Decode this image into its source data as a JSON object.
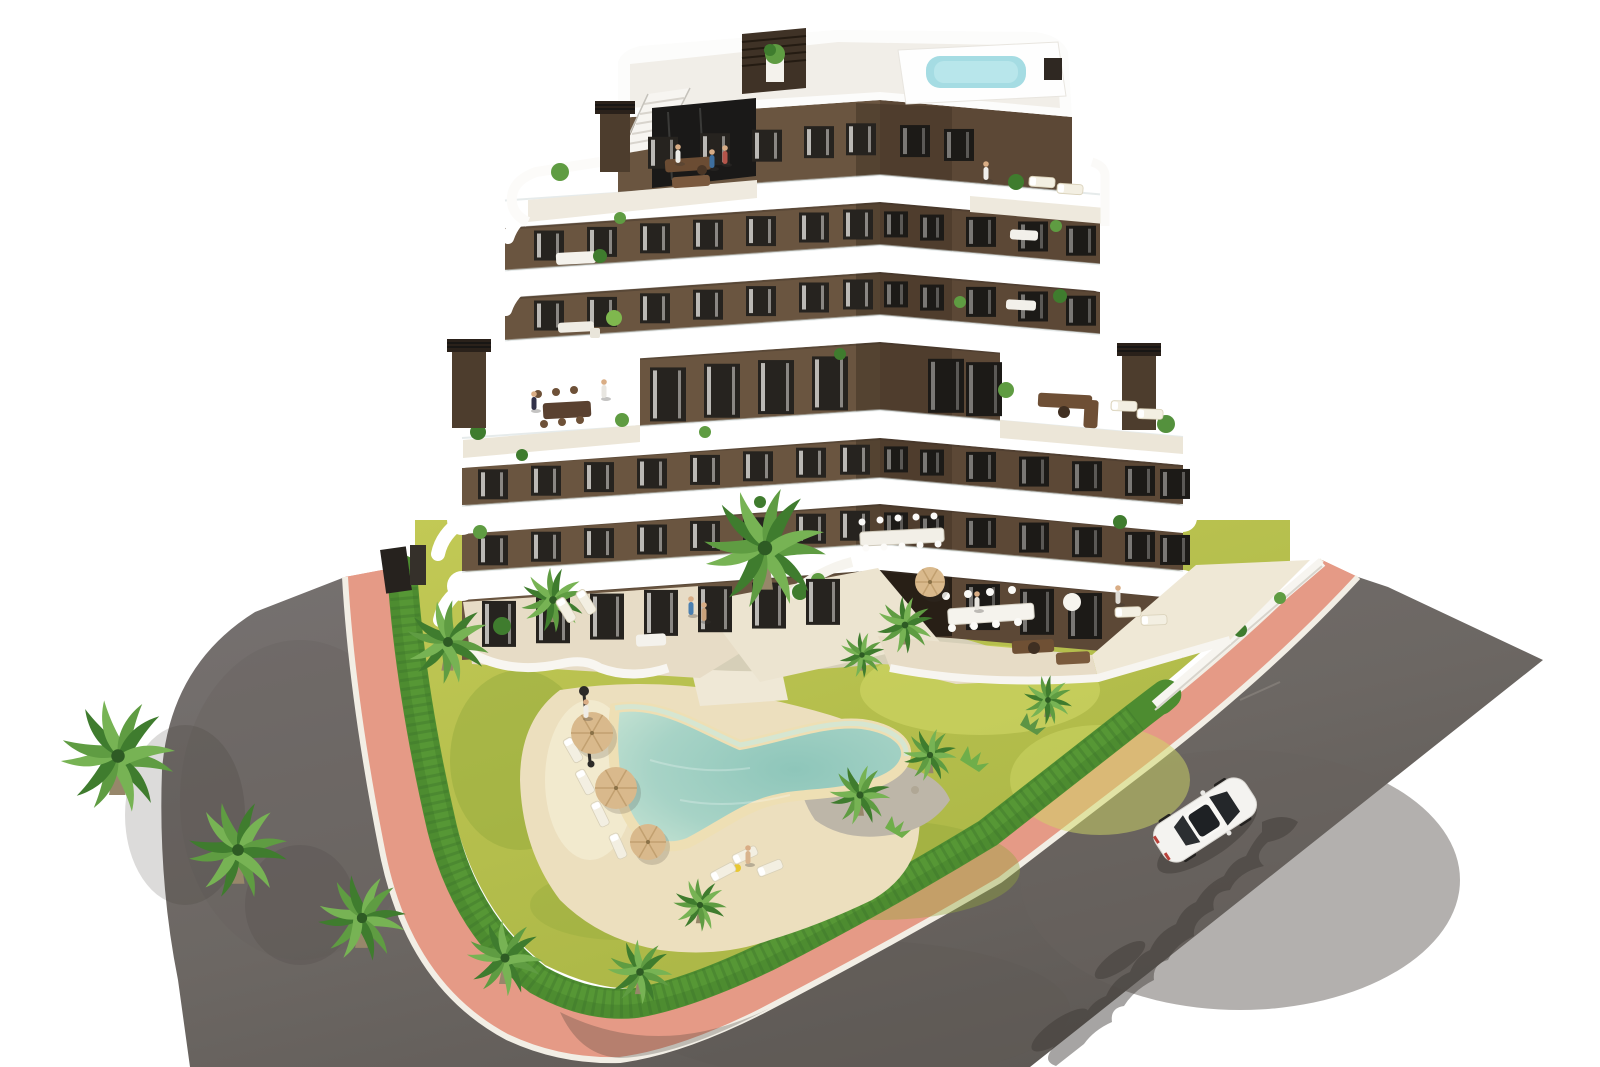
{
  "meta": {
    "title": "Aerial 3D render — modern apartment building with pool garden",
    "scene": "architectural-render"
  },
  "colors": {
    "bg": "#ffffff",
    "road": "#716c68",
    "roadDeep": "#5e5955",
    "roadPatch": "#67625e",
    "scratch": "#9a948c",
    "pink": "#e59a86",
    "pinkDeep": "#d98a75",
    "curb": "#f2eee5",
    "hedge": "#4d8c30",
    "hedgeDark": "#39702a",
    "hedgeLight": "#5ea13a",
    "lawn": "#b9c14e",
    "lawnLight": "#d0d765",
    "lawnDark": "#93a83c",
    "sand": "#ecdfbe",
    "sandLight": "#f4ecd2",
    "gravel": "#bdb6a8",
    "rock": "#b0a795",
    "poolDeep": "#8ec6ba",
    "poolMid": "#a7d3c6",
    "poolShallow": "#cfe7d8",
    "poolRim": "#eedfb4",
    "rooftopPool": "#a5dce3",
    "band": "#ffffff",
    "bandShade": "#dedbd4",
    "slabShadow": "#3c3128",
    "facadeL": "#6a5540",
    "facadeR": "#5c4836",
    "recess": "#463728",
    "archDark": "#281f16",
    "windowGlass": "#26231f",
    "windowGlassDark": "#1c1a17",
    "curtain": "#eeece8",
    "tile": "#e7dcc6",
    "tileLight": "#efe8d6",
    "trunk": "#97876a",
    "palmA": "#5f9c42",
    "palmB": "#3f7c2e",
    "palmC": "#77b354",
    "palmCore": "#2e5b24",
    "umbrella": "#d9b98c",
    "umbrellaRib": "#c2a070",
    "carBody": "#f4f3f0",
    "carGlass": "#24272a",
    "shadow": "#3c3834",
    "metal": "#2c2a27",
    "skin": "#d9ad85",
    "darkWood": "#6b4c33",
    "darkWood2": "#7a593e"
  },
  "building": {
    "floors": 7,
    "has_rooftop_pool": true,
    "has_roof_stair_bulkhead": true,
    "window_rows": [
      {
        "yc": 138,
        "h": 32,
        "w": 30,
        "xs": [
          648,
          700,
          752,
          804,
          846,
          900,
          944
        ]
      },
      {
        "yc": 223,
        "h": 30,
        "w": 30,
        "xs": [
          534,
          587,
          640,
          693,
          746,
          799,
          843,
          966,
          1018,
          1066
        ]
      },
      {
        "yc": 223,
        "h": 26,
        "w": 24,
        "xs": [
          884,
          920
        ],
        "recess": true
      },
      {
        "yc": 293,
        "h": 30,
        "w": 30,
        "xs": [
          534,
          587,
          640,
          693,
          746,
          799,
          843,
          966,
          1018,
          1066
        ]
      },
      {
        "yc": 293,
        "h": 26,
        "w": 24,
        "xs": [
          884,
          920
        ],
        "recess": true
      },
      {
        "yc": 380,
        "h": 54,
        "w": 36,
        "xs": [
          650,
          704,
          758,
          812,
          928,
          966
        ]
      },
      {
        "yc": 458,
        "h": 30,
        "w": 30,
        "xs": [
          478,
          531,
          584,
          637,
          690,
          743,
          796,
          840,
          966,
          1019,
          1072,
          1125,
          1160
        ]
      },
      {
        "yc": 458,
        "h": 26,
        "w": 24,
        "xs": [
          884,
          920
        ],
        "recess": true
      },
      {
        "yc": 524,
        "h": 30,
        "w": 30,
        "xs": [
          478,
          531,
          584,
          637,
          690,
          743,
          796,
          840,
          966,
          1019,
          1072,
          1125,
          1160
        ]
      },
      {
        "yc": 524,
        "h": 26,
        "w": 24,
        "xs": [
          884,
          920
        ],
        "recess": true
      },
      {
        "yc": 598,
        "h": 46,
        "w": 34,
        "xs": [
          482,
          536,
          590,
          644,
          698,
          752,
          806,
          966,
          1020,
          1068
        ]
      }
    ],
    "chimneys": [
      {
        "x": 452,
        "y": 348,
        "w": 34,
        "h": 80
      },
      {
        "x": 1122,
        "y": 352,
        "w": 34,
        "h": 78
      },
      {
        "x": 600,
        "y": 110,
        "w": 30,
        "h": 62
      }
    ]
  },
  "garden": {
    "palms": [
      {
        "x": 118,
        "y": 756,
        "s": 1.5,
        "rot": 10
      },
      {
        "x": 238,
        "y": 850,
        "s": 1.3,
        "rot": 65
      },
      {
        "x": 362,
        "y": 918,
        "s": 1.15,
        "rot": 130
      },
      {
        "x": 505,
        "y": 958,
        "s": 1.0,
        "rot": 20
      },
      {
        "x": 640,
        "y": 972,
        "s": 0.85,
        "rot": 200
      },
      {
        "x": 448,
        "y": 642,
        "s": 1.1,
        "rot": 90
      },
      {
        "x": 553,
        "y": 600,
        "s": 0.85,
        "rot": 160
      },
      {
        "x": 765,
        "y": 548,
        "s": 1.6,
        "rot": 0
      },
      {
        "x": 862,
        "y": 655,
        "s": 0.6,
        "rot": 40
      },
      {
        "x": 905,
        "y": 625,
        "s": 0.75,
        "rot": 220
      },
      {
        "x": 860,
        "y": 795,
        "s": 0.8,
        "rot": 120
      },
      {
        "x": 930,
        "y": 755,
        "s": 0.7,
        "rot": 300
      },
      {
        "x": 1048,
        "y": 700,
        "s": 0.65,
        "rot": 150
      },
      {
        "x": 700,
        "y": 905,
        "s": 0.7,
        "rot": 260
      }
    ],
    "umbrellas": [
      {
        "x": 592,
        "y": 733,
        "r": 21
      },
      {
        "x": 616,
        "y": 788,
        "r": 21
      },
      {
        "x": 648,
        "y": 842,
        "r": 18
      },
      {
        "x": 930,
        "y": 582,
        "r": 15
      }
    ],
    "loungers": [
      {
        "x": 573,
        "y": 750,
        "rot": 60
      },
      {
        "x": 585,
        "y": 782,
        "rot": 62
      },
      {
        "x": 600,
        "y": 814,
        "rot": 64
      },
      {
        "x": 618,
        "y": 846,
        "rot": 66
      },
      {
        "x": 745,
        "y": 855,
        "rot": -25
      },
      {
        "x": 770,
        "y": 868,
        "rot": -22
      },
      {
        "x": 723,
        "y": 872,
        "rot": -28
      },
      {
        "x": 1042,
        "y": 182,
        "rot": 4
      },
      {
        "x": 1070,
        "y": 189,
        "rot": 4
      },
      {
        "x": 1124,
        "y": 406,
        "rot": 2
      },
      {
        "x": 1150,
        "y": 414,
        "rot": 2
      },
      {
        "x": 1128,
        "y": 612,
        "rot": -2
      },
      {
        "x": 1154,
        "y": 620,
        "rot": -2
      },
      {
        "x": 566,
        "y": 610,
        "rot": 58
      },
      {
        "x": 586,
        "y": 602,
        "rot": 58
      }
    ],
    "lamppost": {
      "x": 584,
      "y": 694
    }
  },
  "people": [
    {
      "x": 678,
      "y": 155,
      "c": "#ecebe7"
    },
    {
      "x": 712,
      "y": 160,
      "c": "#3e6f9e"
    },
    {
      "x": 725,
      "y": 156,
      "c": "#b5554a"
    },
    {
      "x": 534,
      "y": 402,
      "c": "#32324a"
    },
    {
      "x": 604,
      "y": 390,
      "c": "#e8e6e1"
    },
    {
      "x": 986,
      "y": 172,
      "c": "#f0efec"
    },
    {
      "x": 1118,
      "y": 596,
      "c": "#dfdcd6"
    },
    {
      "x": 977,
      "y": 602,
      "c": "#e8e5df"
    },
    {
      "x": 586,
      "y": 710,
      "c": "#efece6"
    },
    {
      "x": 691,
      "y": 607,
      "c": "#4a7fb0"
    },
    {
      "x": 704,
      "y": 613,
      "c": "#c9a27b"
    },
    {
      "x": 748,
      "y": 856,
      "c": "#d9b48e"
    }
  ],
  "vehicles": {
    "car": {
      "x": 1205,
      "y": 820,
      "rot": -33
    }
  }
}
